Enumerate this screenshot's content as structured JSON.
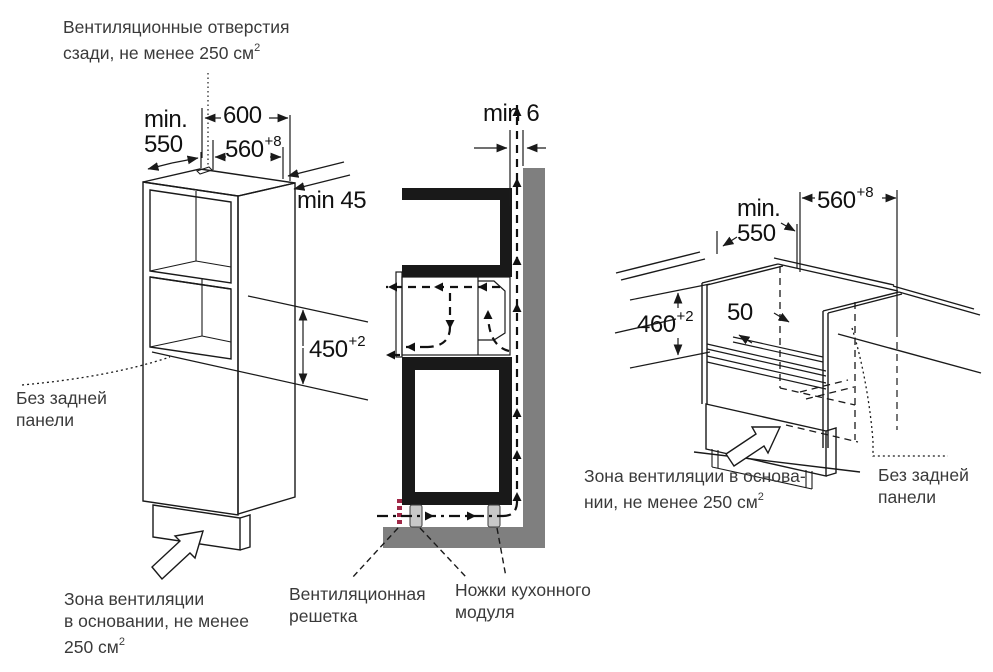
{
  "colors": {
    "line": "#1a1a1a",
    "wall_gray": "#7f7f7f",
    "grille_red": "#a02847",
    "foot_gray": "#c8c8c8",
    "annotation_text": "#3a3a3a"
  },
  "labels": {
    "vent_back_l1": "Вентиляционные отверстия",
    "vent_back_l2": "сзади, не менее 250 см",
    "vent_back_sup": "2",
    "no_back_left_l1": "Без задней",
    "no_back_left_l2": "панели",
    "vent_base_left_l1": "Зона вентиляции",
    "vent_base_left_l2": "в основании, не менее",
    "vent_base_left_l3": "250 см",
    "vent_base_left_sup": "2",
    "grille_l1": "Вентиляционная",
    "grille_l2": "решетка",
    "feet_l1": "Ножки кухонного",
    "feet_l2": "модуля",
    "vent_base_right_l1": "Зона вентиляции в основа-",
    "vent_base_right_l2": "нии, не менее 250 см",
    "vent_base_right_sup": "2",
    "no_back_right_l1": "Без задней",
    "no_back_right_l2": "панели"
  },
  "dims": {
    "left_min": "min.",
    "left_min_550": "550",
    "left_600": "600",
    "left_560": "560",
    "left_560_tol": "+8",
    "left_wall_gap": "min 45",
    "left_niche_h": "450",
    "left_niche_h_tol": "+2",
    "mid_gap": "min 6",
    "right_min": "min.",
    "right_min_550": "550",
    "right_560": "560",
    "right_560_tol": "+8",
    "right_niche_h": "460",
    "right_niche_h_tol": "+2",
    "right_rail": "50"
  }
}
